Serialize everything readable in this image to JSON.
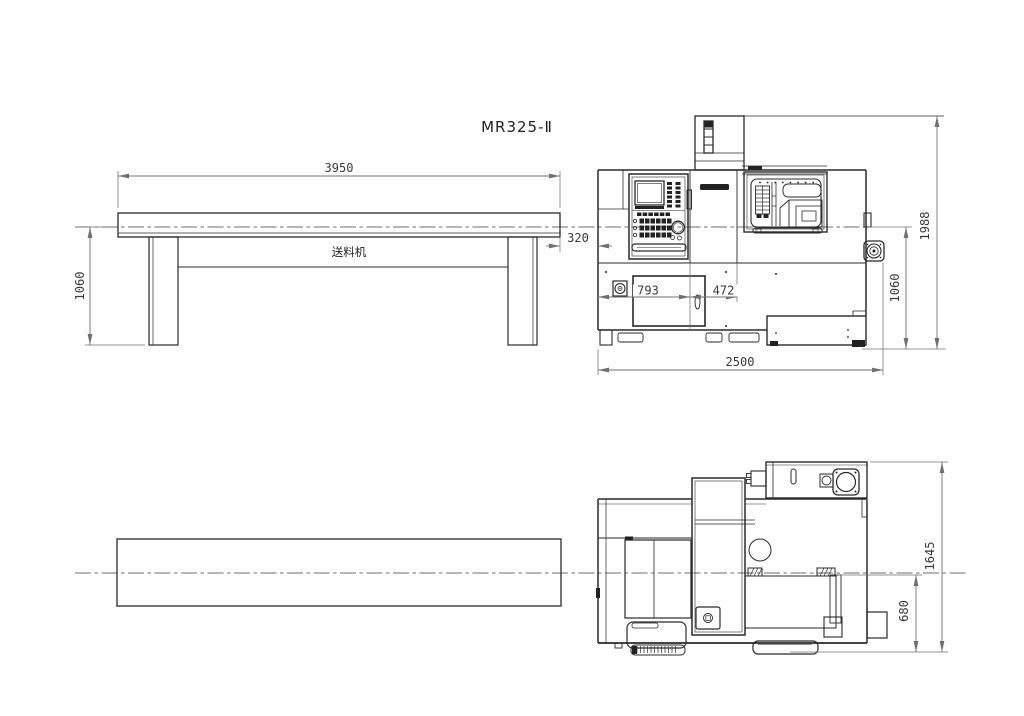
{
  "title": "MR325-Ⅱ",
  "front": {
    "feeder_label": "送料机",
    "dims": {
      "feeder_length": "3950",
      "feeder_height": "1060",
      "gap": "320",
      "panel_left": "793",
      "panel_right": "472",
      "overall_length": "2500",
      "spindle_height": "1060",
      "overall_height": "1988"
    }
  },
  "plan": {
    "dims": {
      "overall_depth": "1645",
      "front_depth": "680"
    }
  },
  "colors": {
    "object_line": "#2a2a2a",
    "dimension_line": "#707070",
    "dimension_text": "#3a3a3a",
    "background": "#ffffff"
  }
}
